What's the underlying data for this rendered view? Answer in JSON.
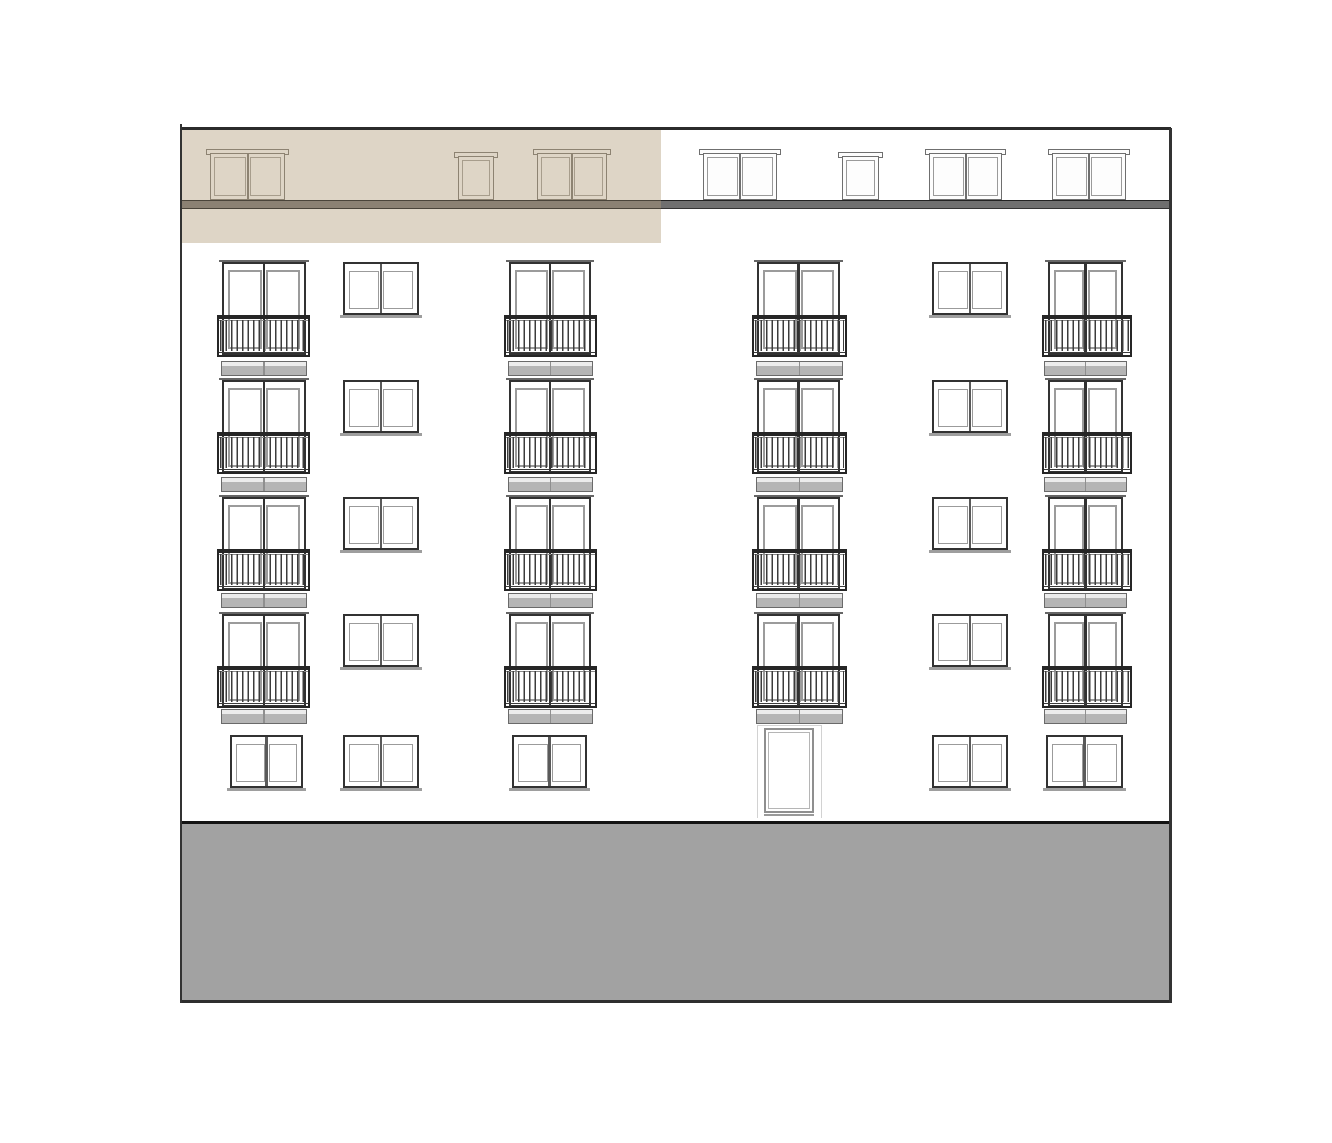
{
  "canvas": {
    "width": 1332,
    "height": 1143,
    "background": "#ffffff"
  },
  "colors": {
    "wall": "#ffffff",
    "outline_dark": "#2b2b2b",
    "edge_line": "#333333",
    "frame_dark": "#323232",
    "frame_mid": "#5a5a5a",
    "frame_inner": "#9b9b9b",
    "lintel": "#666666",
    "sill": "#9e9e9e",
    "rail_dark": "#262626",
    "rail_bar": "#3c3c3c",
    "rail_light_line": "#8a8a8a",
    "slab_fill": "#b5b5b5",
    "slab_light": "#ececec",
    "slab_border": "#6a6a6a",
    "roof_band": "#6f6f6f",
    "roof_band_tinted": "#8b8173",
    "highlight_beige": "#ded5c6",
    "highlight_line": "#8d8372",
    "highlight_inner": "#a79d8c",
    "roof_frame": "#6f6f6f",
    "roof_inner": "#9a9a9a",
    "base_fill": "#a2a2a2",
    "base_border_top": "#141414",
    "base_border_bottom": "#2e2e2e",
    "door_frame": "#8f8f8f",
    "door_inner": "#b5b5b5",
    "door_surround": "#d2d2d2"
  },
  "building": {
    "left_edge": {
      "x": 180,
      "y": 124,
      "w": 2,
      "h": 879
    },
    "right_edge": {
      "x": 1169,
      "y": 128,
      "w": 2.5,
      "h": 875
    },
    "top_edge": {
      "x": 180,
      "y": 127,
      "w": 991,
      "h": 2.5
    }
  },
  "highlight_unit": {
    "x": 182,
    "y": 129,
    "w": 479,
    "h": 114
  },
  "roof": {
    "band": {
      "x": 181,
      "y": 200,
      "w": 990,
      "h": 9
    },
    "band_highlight_segment": {
      "x": 182,
      "w": 479
    },
    "double_y": 149,
    "double_h": 51,
    "single_y": 152,
    "single_h": 48,
    "windows": [
      {
        "kind": "double",
        "x": 210,
        "w": 75,
        "zone": "highlight"
      },
      {
        "kind": "single",
        "x": 458,
        "w": 36,
        "zone": "highlight"
      },
      {
        "kind": "double",
        "x": 537,
        "w": 70,
        "zone": "highlight"
      },
      {
        "kind": "double",
        "x": 703,
        "w": 74,
        "zone": "plain"
      },
      {
        "kind": "single",
        "x": 842,
        "w": 37,
        "zone": "plain"
      },
      {
        "kind": "double",
        "x": 929,
        "w": 73,
        "zone": "plain"
      },
      {
        "kind": "double",
        "x": 1052,
        "w": 74,
        "zone": "plain"
      }
    ]
  },
  "floors": {
    "window_h": 93,
    "rail_h": 42,
    "slab_h": 15,
    "plain_h": 53,
    "rows": [
      {
        "win_y": 262,
        "rail_y": 315,
        "slab_y": 361
      },
      {
        "win_y": 380,
        "rail_y": 432,
        "slab_y": 477
      },
      {
        "win_y": 497,
        "rail_y": 549,
        "slab_y": 593
      },
      {
        "win_y": 614,
        "rail_y": 666,
        "slab_y": 709
      }
    ],
    "columns": [
      {
        "id": "A",
        "type": "balcony",
        "win_x": 222,
        "win_w": 84,
        "rail_x": 217,
        "rail_w": 93,
        "slab_x": 221,
        "slab_w": 86
      },
      {
        "id": "B",
        "type": "plain",
        "win_x": 343,
        "win_w": 76
      },
      {
        "id": "C",
        "type": "balcony",
        "win_x": 509,
        "win_w": 82,
        "rail_x": 504,
        "rail_w": 93,
        "slab_x": 508,
        "slab_w": 85
      },
      {
        "id": "D",
        "type": "balcony",
        "win_x": 757,
        "win_w": 83,
        "rail_x": 752,
        "rail_w": 95,
        "slab_x": 756,
        "slab_w": 87
      },
      {
        "id": "E",
        "type": "plain",
        "win_x": 932,
        "win_w": 76
      },
      {
        "id": "F",
        "type": "balcony",
        "win_x": 1048,
        "win_w": 75,
        "rail_x": 1042,
        "rail_w": 90,
        "slab_x": 1044,
        "slab_w": 83
      }
    ]
  },
  "ground_floor": {
    "win_y": 735,
    "win_h": 53,
    "windows": [
      {
        "x": 230,
        "w": 73
      },
      {
        "x": 343,
        "w": 76
      },
      {
        "x": 512,
        "w": 75
      },
      {
        "x": 932,
        "w": 76
      },
      {
        "x": 1046,
        "w": 77
      }
    ],
    "door": {
      "surround": {
        "x": 757,
        "y": 725,
        "w": 65,
        "h": 93
      },
      "leaf": {
        "x": 764,
        "y": 728,
        "w": 50,
        "h": 85
      },
      "threshold": {
        "x": 764,
        "y": 814,
        "w": 50,
        "h": 1.5
      }
    }
  },
  "base": {
    "x": 181,
    "y": 821,
    "w": 990,
    "h": 182
  }
}
